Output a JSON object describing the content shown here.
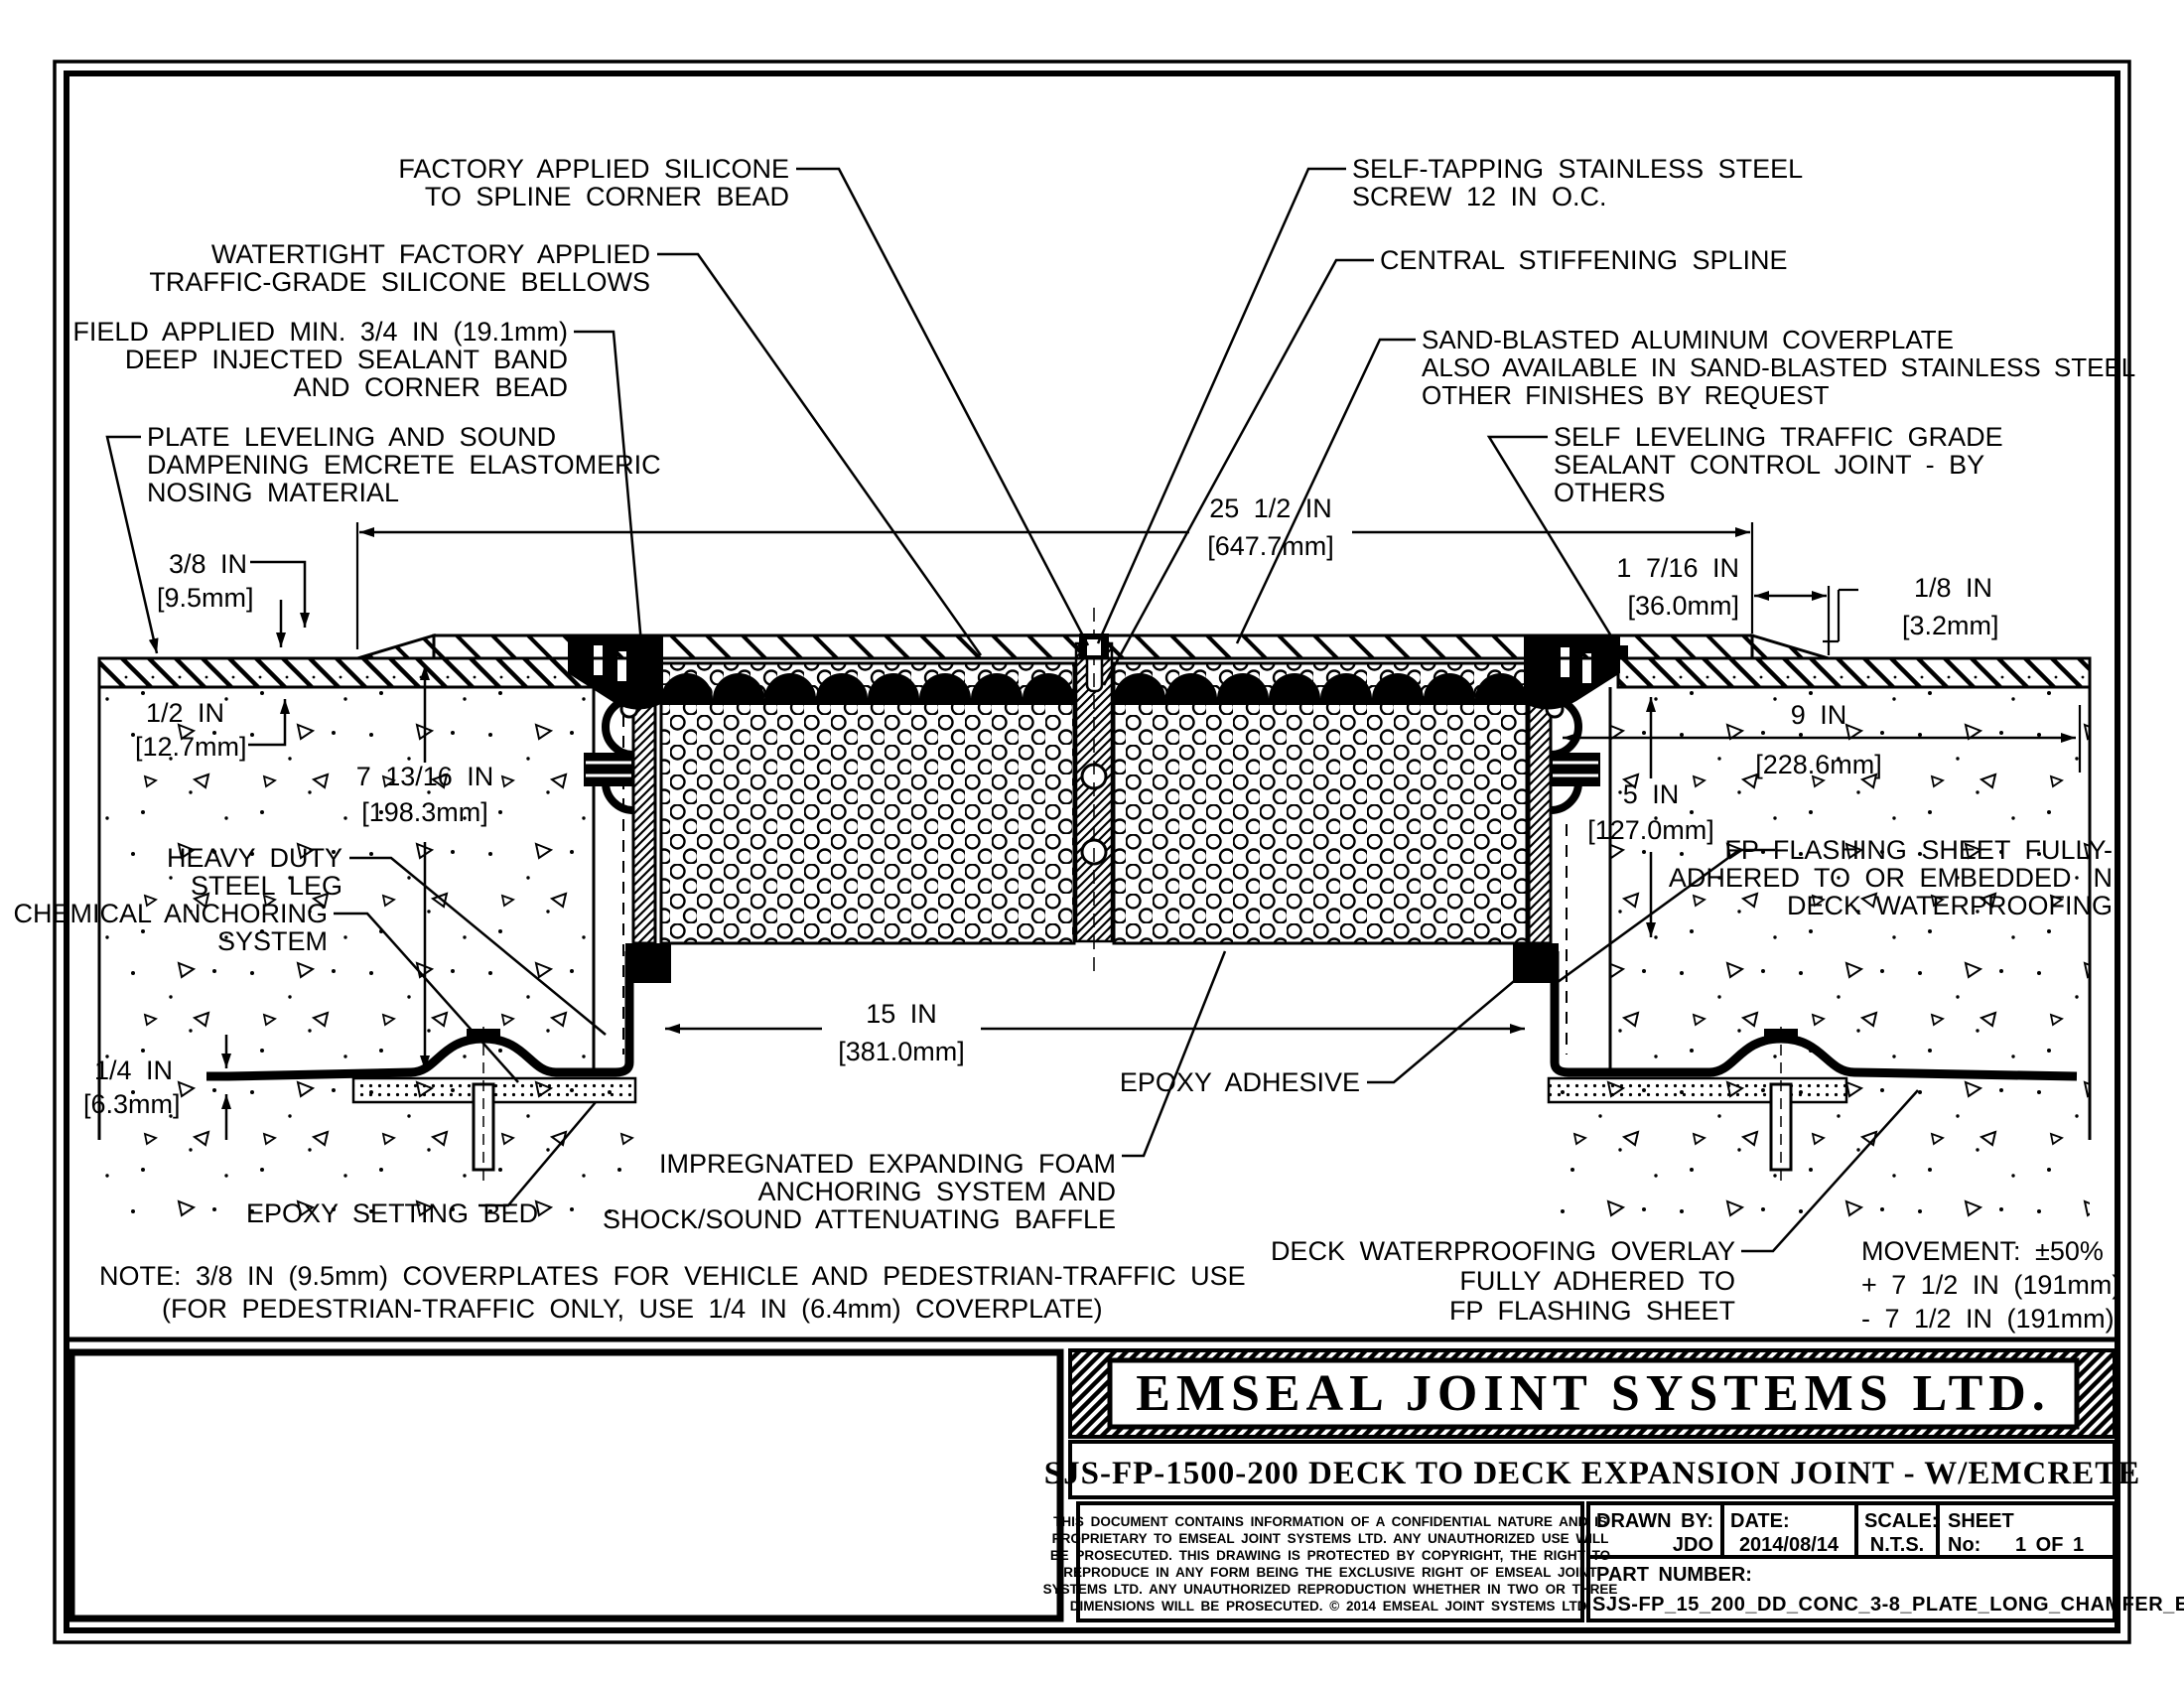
{
  "annotations": {
    "factory_silicone": {
      "lines": [
        "FACTORY APPLIED SILICONE",
        "TO SPLINE CORNER BEAD"
      ]
    },
    "watertight": {
      "lines": [
        "WATERTIGHT FACTORY APPLIED",
        "TRAFFIC-GRADE SILICONE BELLOWS"
      ]
    },
    "field_applied": {
      "lines": [
        "FIELD APPLIED MIN. 3/4 IN (19.1mm)",
        "DEEP INJECTED SEALANT BAND",
        "AND CORNER BEAD"
      ]
    },
    "plate_leveling": {
      "lines": [
        "PLATE LEVELING AND SOUND",
        "DAMPENING EMCRETE ELASTOMERIC",
        "NOSING MATERIAL"
      ]
    },
    "heavy_duty": {
      "lines": [
        "HEAVY DUTY",
        "STEEL LEG"
      ]
    },
    "chemical": {
      "lines": [
        "CHEMICAL ANCHORING",
        "SYSTEM"
      ]
    },
    "epoxy_bed": {
      "lines": [
        "EPOXY SETTING BED"
      ]
    },
    "self_tapping": {
      "lines": [
        "SELF-TAPPING STAINLESS STEEL",
        "SCREW 12 IN O.C."
      ]
    },
    "central_spline": {
      "lines": [
        "CENTRAL STIFFENING SPLINE"
      ]
    },
    "sand_blasted": {
      "lines": [
        "SAND-BLASTED ALUMINUM COVERPLATE",
        "ALSO AVAILABLE IN SAND-BLASTED STAINLESS STEEL",
        "OTHER FINISHES BY REQUEST"
      ]
    },
    "self_leveling": {
      "lines": [
        "SELF LEVELING TRAFFIC GRADE",
        "SEALANT CONTROL JOINT - BY",
        "OTHERS"
      ]
    },
    "fp_flashing": {
      "lines": [
        "FP FLASHING SHEET FULLY-",
        "ADHERED TO OR EMBEDDED IN",
        "DECK WATERPROOFING"
      ]
    },
    "epoxy_adhesive": {
      "lines": [
        "EPOXY ADHESIVE"
      ]
    },
    "impregnated": {
      "lines": [
        "IMPREGNATED EXPANDING FOAM",
        "ANCHORING SYSTEM AND",
        "SHOCK/SOUND ATTENUATING BAFFLE"
      ]
    },
    "deck_overlay": {
      "lines": [
        "DECK WATERPROOFING OVERLAY",
        "FULLY ADHERED TO",
        "FP FLASHING SHEET"
      ]
    },
    "movement": {
      "lines": [
        "MOVEMENT: ±50%",
        "+ 7 1/2 IN (191mm)",
        "- 7 1/2 IN (191mm)"
      ]
    }
  },
  "dimensions": {
    "cover_width": {
      "in": "25 1/2 IN",
      "mm": "[647.7mm]"
    },
    "chamfer": {
      "in": "1 7/16 IN",
      "mm": "[36.0mm]"
    },
    "recess": {
      "in": "1/8 IN",
      "mm": "[3.2mm]"
    },
    "plate_thk": {
      "in": "3/8 IN",
      "mm": "[9.5mm]"
    },
    "topping_thk": {
      "in": "1/2 IN",
      "mm": "[12.7mm]"
    },
    "block_depth": {
      "in": "7 13/16 IN",
      "mm": "[198.3mm]"
    },
    "overlay_width": {
      "in": "9 IN",
      "mm": "[228.6mm]"
    },
    "foam_depth": {
      "in": "5 IN",
      "mm": "[127.0mm]"
    },
    "foam_width": {
      "in": "15 IN",
      "mm": "[381.0mm]"
    },
    "flashing_thk": {
      "in": "1/4 IN",
      "mm": "[6.3mm]"
    }
  },
  "note": {
    "line1": "NOTE: 3/8 IN (9.5mm) COVERPLATES FOR VEHICLE AND PEDESTRIAN-TRAFFIC USE",
    "line2": "(FOR PEDESTRIAN-TRAFFIC ONLY, USE 1/4 IN (6.4mm) COVERPLATE)"
  },
  "title_block": {
    "company": "EMSEAL JOINT SYSTEMS LTD.",
    "drawing_title": "SJS-FP-1500-200   DECK TO DECK EXPANSION JOINT - W/EMCRETE",
    "legal_lines": [
      "THIS DOCUMENT CONTAINS INFORMATION OF A CONFIDENTIAL NATURE AND IS",
      "PROPRIETARY TO EMSEAL JOINT SYSTEMS LTD. ANY UNAUTHORIZED USE WILL",
      "BE PROSECUTED. THIS DRAWING IS PROTECTED BY COPYRIGHT, THE RIGHT TO",
      "REPRODUCE IN ANY FORM BEING THE EXCLUSIVE RIGHT OF EMSEAL JOINT",
      "SYSTEMS LTD. ANY UNAUTHORIZED REPRODUCTION WHETHER IN TWO OR THREE",
      "DIMENSIONS WILL BE PROSECUTED. © 2014 EMSEAL JOINT SYSTEMS LTD."
    ],
    "fields": {
      "drawn_by_label": "DRAWN BY:",
      "drawn_by": "JDO",
      "date_label": "DATE:",
      "date": "2014/08/14",
      "scale_label": "SCALE:",
      "scale": "N.T.S.",
      "sheet_label": "SHEET",
      "sheet_no_label": "No:",
      "sheet": "1 OF 1",
      "part_number_label": "PART NUMBER:",
      "part_number": "SJS-FP_15_200_DD_CONC_3-8_PLATE_LONG_CHAMFER_EMCRETE"
    }
  }
}
